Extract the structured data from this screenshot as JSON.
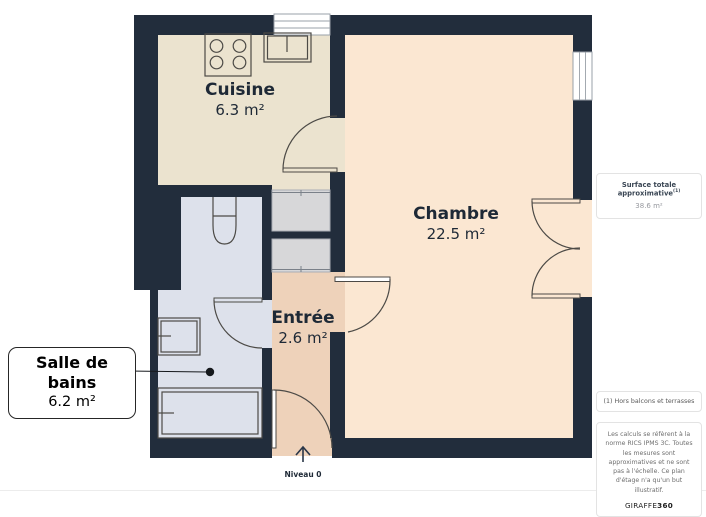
{
  "plan": {
    "rooms": [
      {
        "id": "cuisine",
        "name": "Cuisine",
        "area": "6.3 m²"
      },
      {
        "id": "chambre",
        "name": "Chambre",
        "area": "22.5 m²"
      },
      {
        "id": "entree",
        "name": "Entrée",
        "area": "2.6 m²"
      },
      {
        "id": "salle_de_bains",
        "name": "Salle de bains",
        "area": "6.2 m²"
      }
    ],
    "level_label": "Niveau 0",
    "fixtures": [
      "stove-icon",
      "kitchen-sink-icon",
      "toilet-icon",
      "bathroom-sink-icon",
      "shower-icon",
      "wardrobe-icon",
      "entrance-arrow-icon",
      "window-icon",
      "door-arc-icon"
    ]
  },
  "sidebar": {
    "surface_title": "Surface totale approximative",
    "surface_superscript": "(1)",
    "surface_value": "38.6 m²",
    "footnote": "(1) Hors balcons et terrasses",
    "legal": "Les calculs se réfèrent à la norme RICS IPMS 3C. Toutes les mesures sont approximatives et ne sont pas à l'échelle. Ce plan d'étage n'a qu'un but illustratif.",
    "brand": {
      "name": "GIRAFFE",
      "suffix": "360"
    }
  },
  "colors": {
    "wall": "#222d3c",
    "cuisine": "#ebe3cf",
    "chambre": "#fbe7d2",
    "entree": "#eed2ba",
    "bath": "#dde1eb",
    "closet": "#d7d7d9",
    "line": "#4c4a46",
    "text": "#1e2936"
  }
}
